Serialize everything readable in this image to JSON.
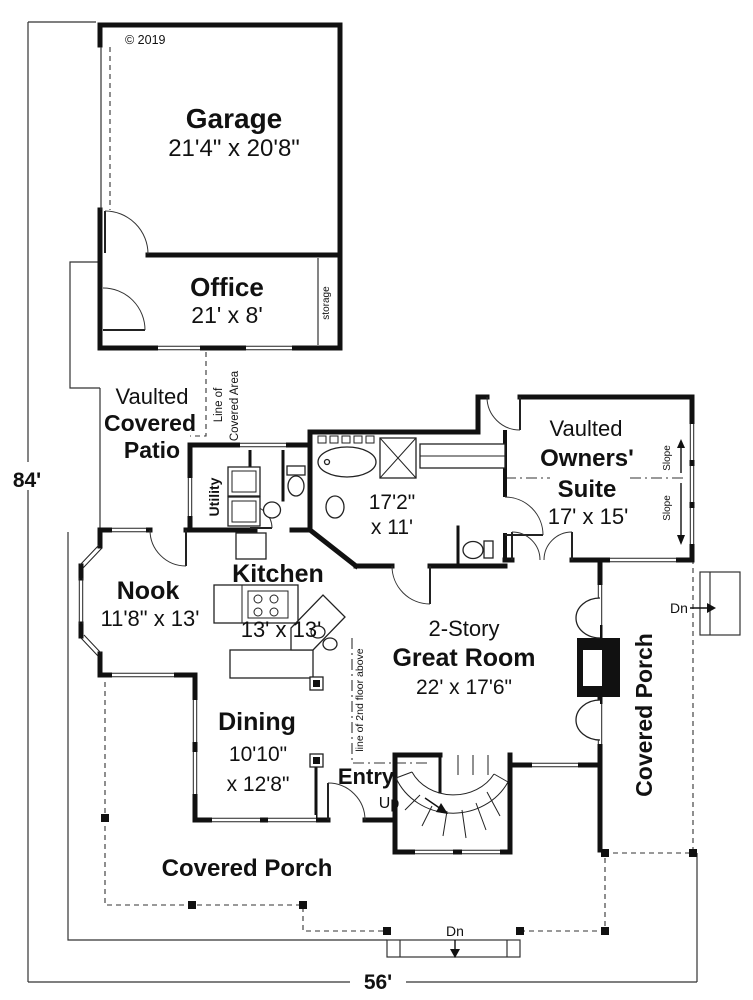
{
  "meta": {
    "copyright": "© 2019"
  },
  "overall_dimensions": {
    "height_label": "84'",
    "width_label": "56'"
  },
  "rooms": {
    "garage": {
      "name": "Garage",
      "size": "21'4\" x 20'8\""
    },
    "office": {
      "name": "Office",
      "size": "21' x 8'"
    },
    "storage": {
      "label": "storage"
    },
    "patio": {
      "line1": "Vaulted",
      "line2": "Covered",
      "line3": "Patio"
    },
    "utility": {
      "label": "Utility"
    },
    "owners_bath": {
      "size_line1": "17'2\"",
      "size_line2": "x 11'"
    },
    "owners_suite": {
      "line1": "Vaulted",
      "line2": "Owners'",
      "line3": "Suite",
      "size": "17' x 15'"
    },
    "nook": {
      "name": "Nook",
      "size": "11'8\" x 13'"
    },
    "kitchen": {
      "name": "Kitchen",
      "size": "13' x 13'"
    },
    "great_room": {
      "line1": "2-Story",
      "line2": "Great Room",
      "size": "22' x 17'6\""
    },
    "dining": {
      "name": "Dining",
      "size_line1": "10'10\"",
      "size_line2": "x 12'8\""
    },
    "entry": {
      "name": "Entry",
      "up_label": "Up"
    },
    "porch_bottom": {
      "name": "Covered Porch",
      "dn_label": "Dn"
    },
    "porch_right": {
      "name": "Covered Porch",
      "dn_label": "Dn"
    }
  },
  "annotations": {
    "line_of_covered_area_1": "Line of",
    "line_of_covered_area_2": "Covered Area",
    "line_of_2nd_floor": "line of 2nd floor above",
    "slope": "Slope"
  },
  "colors": {
    "wall": "#111111",
    "background": "#ffffff"
  }
}
